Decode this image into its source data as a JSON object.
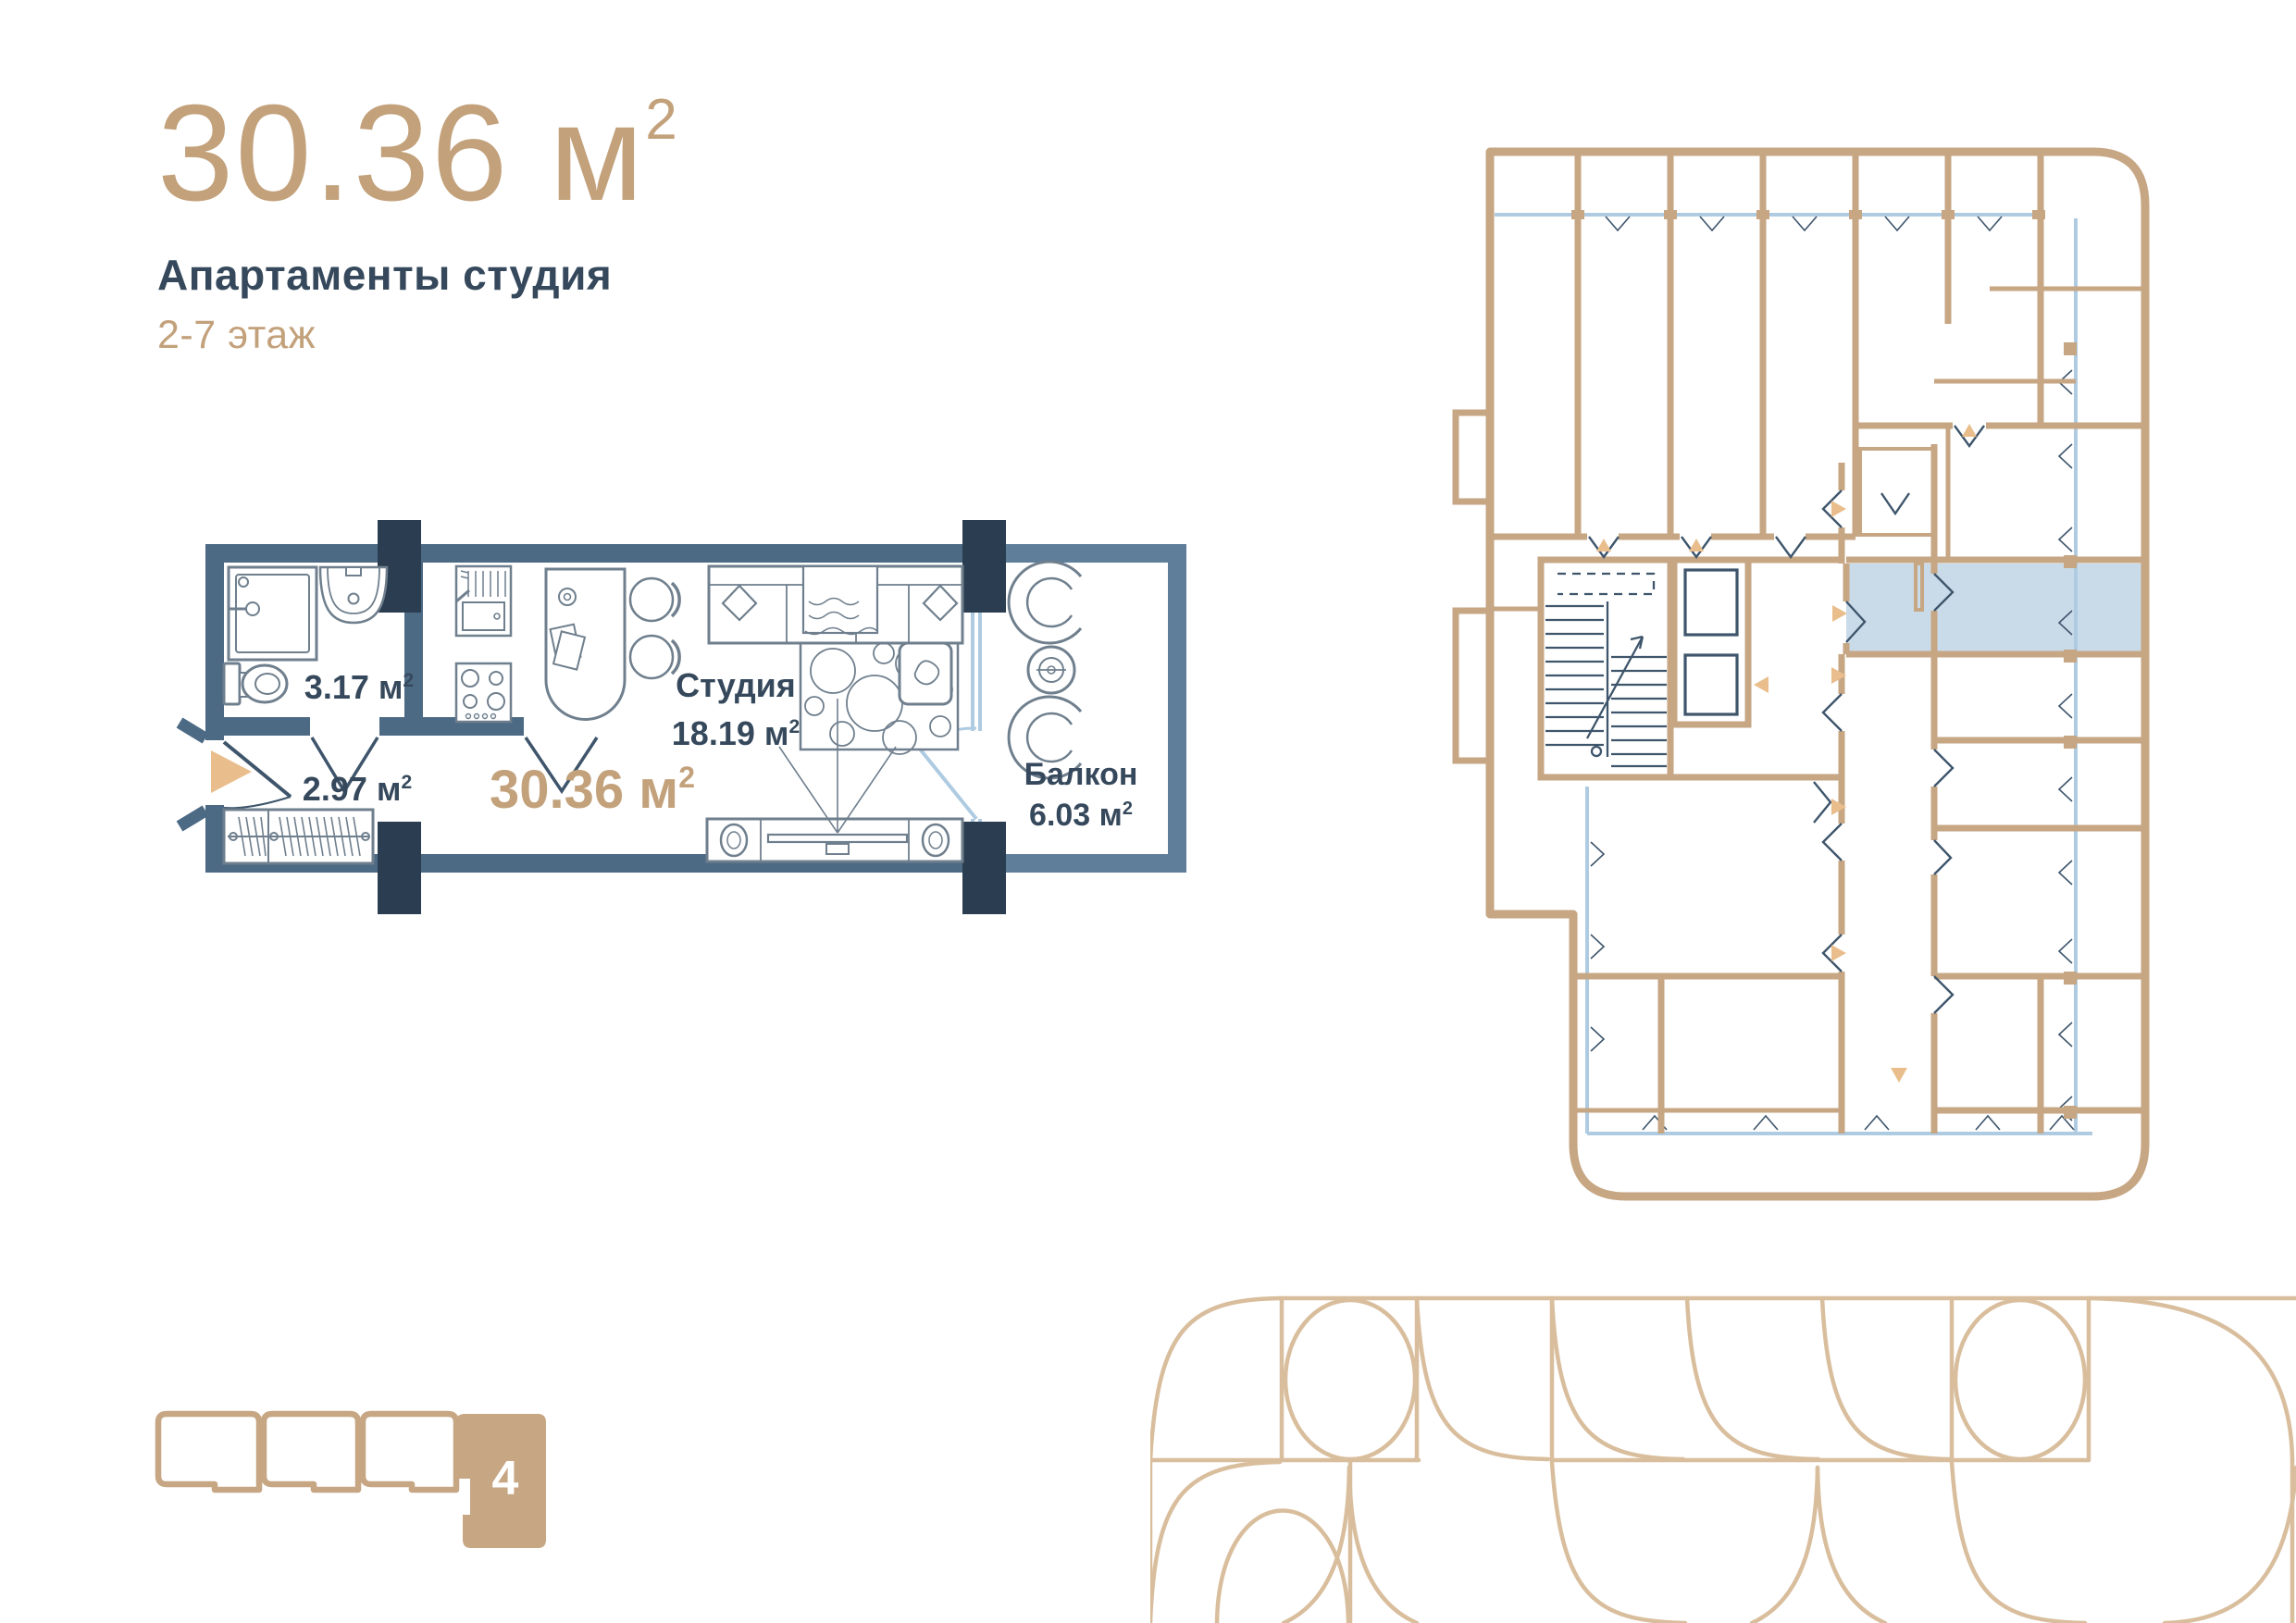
{
  "header": {
    "area_value": "30.36 м",
    "area_sup": "2",
    "property_type": "Апартаменты студия",
    "floors": "2-7 этаж"
  },
  "unit_plan": {
    "bathroom_area": "3.17 м",
    "bathroom_sup": "2",
    "hallway_area": "2.97 м",
    "hallway_sup": "2",
    "studio_name": "Студия",
    "studio_area": "18.19 м",
    "studio_sup": "2",
    "total_area": "30.36 м",
    "total_sup": "2",
    "balcony_name": "Балкон",
    "balcony_area": "6.03 м",
    "balcony_sup": "2"
  },
  "position_indicator": {
    "section_number": "4"
  },
  "colors": {
    "accent_tan": "#C2A17B",
    "arrow_tan": "#E9BE8C",
    "wall_steel": "#4D6A85",
    "balcony_wall": "#5F7E9A",
    "pillar_dark": "#2B3D50",
    "text_navy": "#36495C",
    "building_tan": "#C6A683",
    "glazing_blue": "#AECBE1",
    "highlight_blue": "#C9DBE9",
    "pattern_tan": "#D9BE9D"
  }
}
